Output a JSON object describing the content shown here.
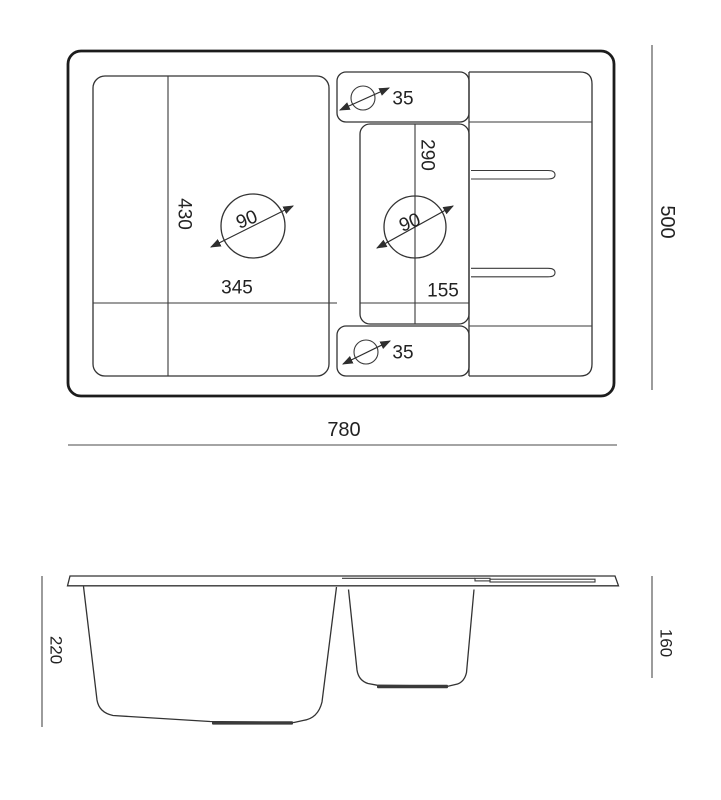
{
  "drawing_type": "kitchen sink technical drawing (top view and section view)",
  "top_view": {
    "overall_width": "780",
    "overall_depth": "500",
    "main_bowl_length": "430",
    "main_bowl_width": "345",
    "main_drain_diameter": "90",
    "small_bowl_length": "290",
    "small_bowl_width": "155",
    "small_drain_diameter": "90",
    "tap_hole_top_diameter": "35",
    "tap_hole_bottom_diameter": "35"
  },
  "side_view": {
    "main_bowl_depth": "220",
    "small_bowl_depth": "160"
  },
  "colors": {
    "line": "#333333",
    "outer_line": "#1c1c1c",
    "background": "#ffffff",
    "text": "#222222"
  }
}
